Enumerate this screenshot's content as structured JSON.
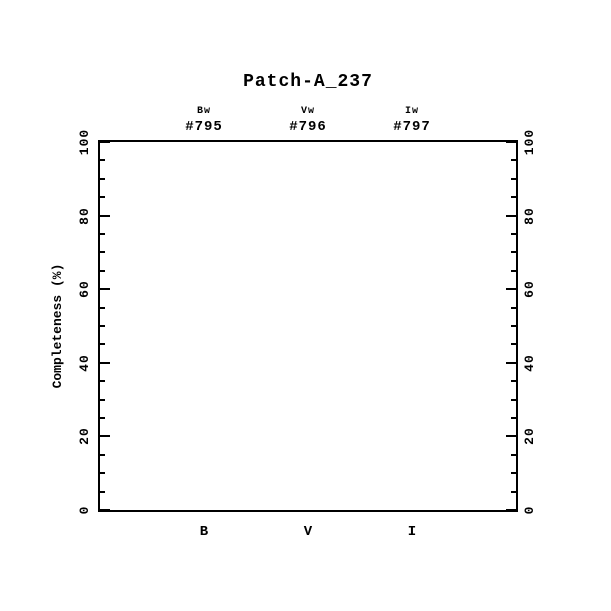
{
  "figure": {
    "background": "#ffffff",
    "foreground": "#000000"
  },
  "chart_data": {
    "type": "scatter",
    "title": "Patch-A_237",
    "xlabel": "",
    "ylabel": "Completeness (%)",
    "ylim": [
      0,
      100
    ],
    "y_major_ticks": [
      0,
      20,
      40,
      60,
      80,
      100
    ],
    "y_minor_tick_step": 5,
    "ticks_on_both_sides": true,
    "grid": false,
    "legend": null,
    "axis_color": "#000000",
    "background": "#ffffff",
    "x_categories": [
      {
        "label": "B",
        "position": 0.25
      },
      {
        "label": "V",
        "position": 0.5
      },
      {
        "label": "I",
        "position": 0.75
      }
    ],
    "top_annotations": [
      {
        "filter": "Bw",
        "count": "#795",
        "position": 0.25
      },
      {
        "filter": "Vw",
        "count": "#796",
        "position": 0.5
      },
      {
        "filter": "Iw",
        "count": "#797",
        "position": 0.75
      }
    ],
    "series": []
  }
}
